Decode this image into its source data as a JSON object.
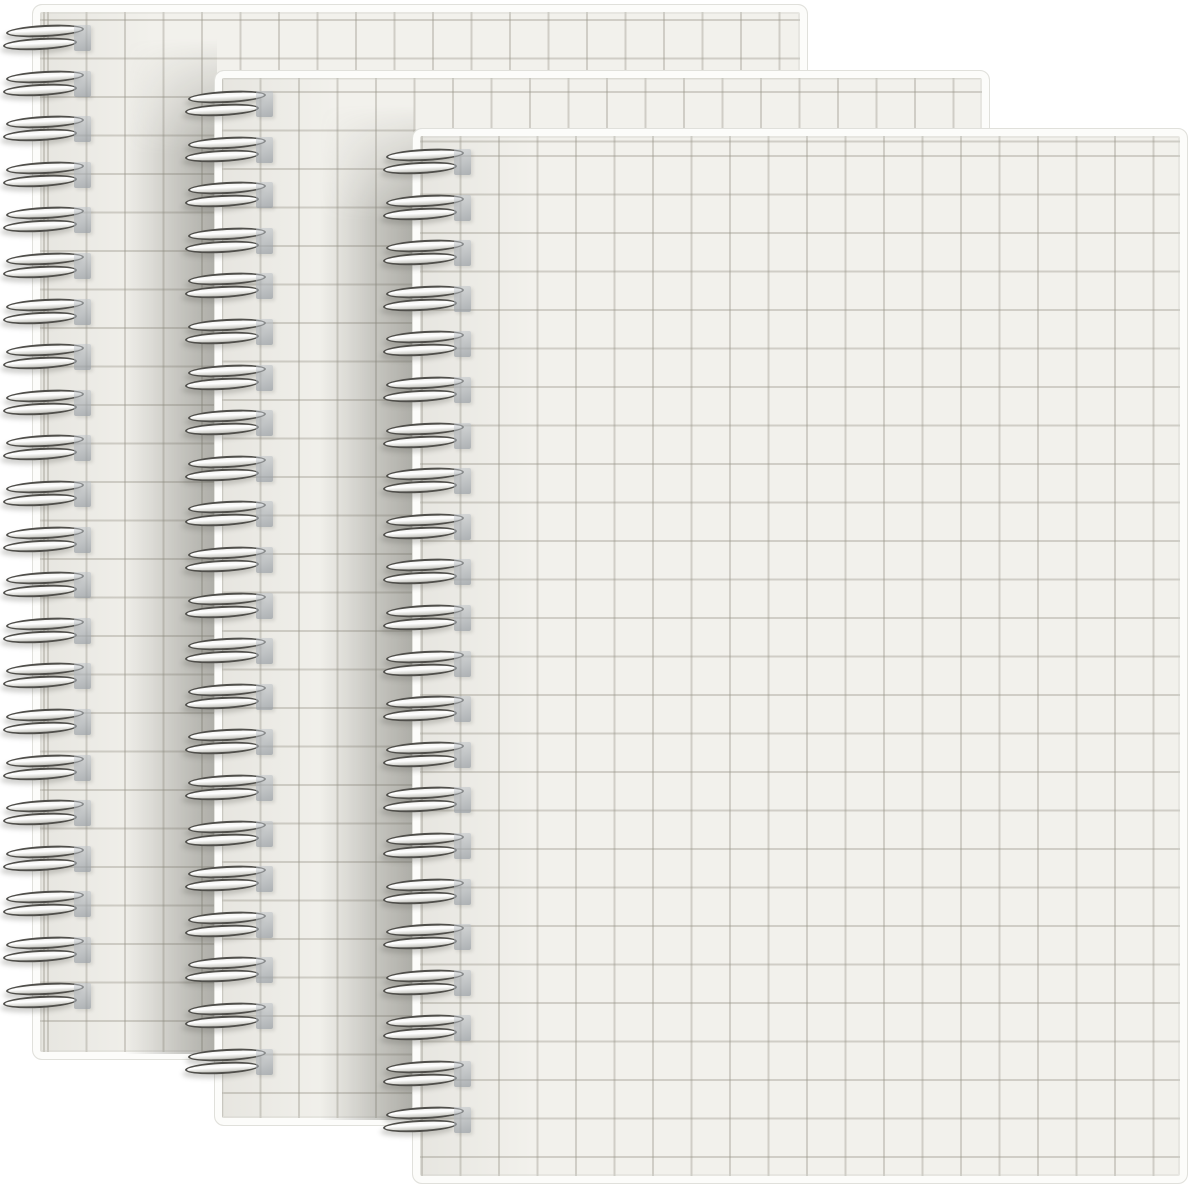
{
  "scene": {
    "type": "product-photo",
    "description": "Three overlapping spiral-bound notebooks with off-white graph-grid covers on a white background",
    "background_color": "#ffffff",
    "image_width": 1200,
    "image_height": 1191,
    "notebook_count": 3
  },
  "style": {
    "cover_color": "#f2f1ec",
    "grid_line_color": "rgba(151,148,136,0.38)",
    "grid_cell_px": 38.5,
    "grid_line_px": 2,
    "edge_highlight_color": "#fcfcfa",
    "edge_outline_color": "#e0e0db",
    "wire_dark_color": "#4f4e4a",
    "wire_highlight_color": "#ffffff",
    "punch_hole_color_top": "rgba(198,203,208,0.50)",
    "punch_hole_color_bottom": "rgba(148,154,160,0.72)",
    "cast_shadow_color": "rgba(104,104,97,0.50)",
    "corner_radius_px": 10
  },
  "notebooks": [
    {
      "name": "back",
      "z": 1,
      "left": 32,
      "top": 4,
      "width": 776,
      "height": 1056,
      "coil_count": 22,
      "coil_first_top": 21,
      "coil_pitch": 45.6,
      "grid_offset_x": 14,
      "grid_offset_y": 14,
      "shadow_band": {
        "left": 93,
        "width": 92
      }
    },
    {
      "name": "middle",
      "z": 2,
      "left": 214,
      "top": 70,
      "width": 776,
      "height": 1056,
      "coil_count": 22,
      "coil_first_top": 21,
      "coil_pitch": 45.6,
      "grid_offset_x": 6,
      "grid_offset_y": 20,
      "shadow_band": {
        "left": 106,
        "width": 94
      }
    },
    {
      "name": "front",
      "z": 3,
      "left": 412,
      "top": 128,
      "width": 776,
      "height": 1056,
      "coil_count": 22,
      "coil_first_top": 21,
      "coil_pitch": 45.6,
      "grid_offset_x": 8,
      "grid_offset_y": 26,
      "shadow_band": null
    }
  ]
}
